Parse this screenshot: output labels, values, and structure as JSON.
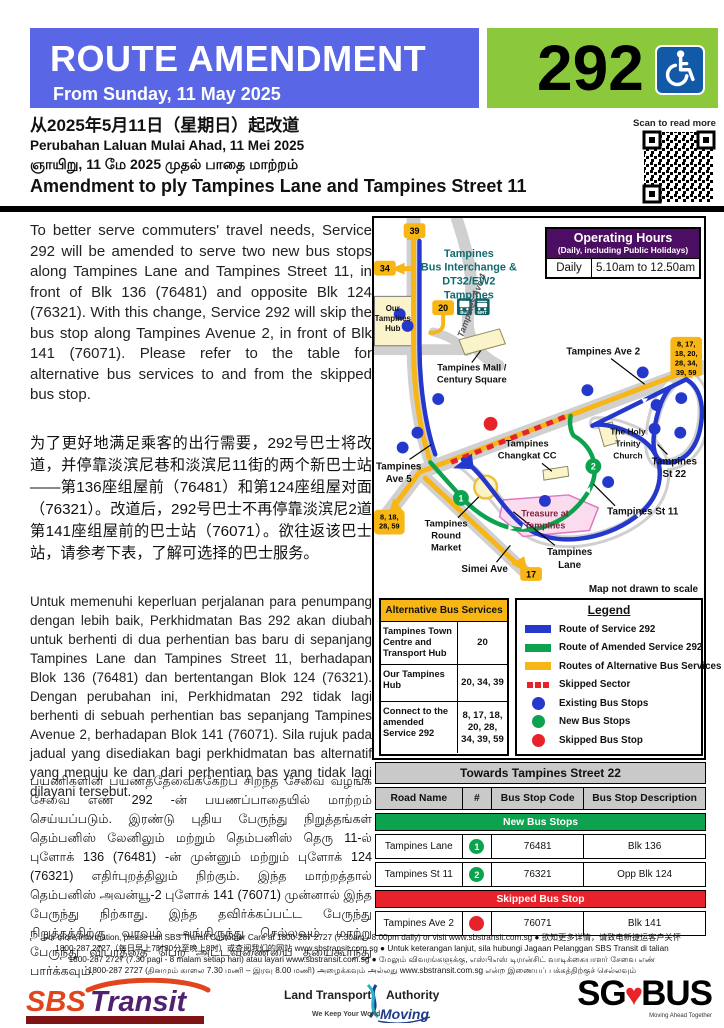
{
  "banner": {
    "title": "ROUTE AMENDMENT",
    "subtitle": "From Sunday, 11 May 2025",
    "service_number": "292",
    "banner_color": "#5967E6",
    "service_box_color": "#8CC83C"
  },
  "qr": {
    "label": "Scan to read more"
  },
  "headings": {
    "zh": "从2025年5月11日（星期日）起改道",
    "ms": "Perubahan Laluan Mulai Ahad, 11 Mei 2025",
    "ta": "ஞாயிறு, 11 மே 2025 முதல் பாதை மாற்றம்",
    "en": "Amendment to ply Tampines Lane and Tampines Street 11"
  },
  "paragraphs": {
    "en": "To better serve commuters' travel needs, Service 292 will be amended to serve two new bus stops along Tampines Lane and Tampines Street 11, in front of Blk 136 (76481) and opposite Blk 124 (76321). With this change, Service 292 will skip the bus stop along Tampines Avenue 2, in front of Blk 141 (76071). Please refer to the table for alternative bus services to and from the skipped bus stop.",
    "zh": "为了更好地满足乘客的出行需要，292号巴士将改道，并停靠淡滨尼巷和淡滨尼11街的两个新巴士站——第136座组屋前（76481）和第124座组屋对面（76321）。改道后，292号巴士不再停靠淡滨尼2道第141座组屋前的巴士站（76071）。欲往返该巴士站，请参考下表，了解可选择的巴士服务。",
    "ms": "Untuk memenuhi keperluan perjalanan para penumpang dengan lebih baik, Perkhidmatan Bas 292 akan diubah untuk berhenti di dua perhentian bas baru di sepanjang Tampines Lane dan Tampines Street 11, berhadapan Blok 136 (76481) dan bertentangan Blok 124 (76321). Dengan perubahan ini, Perkhidmatan 292 tidak lagi berhenti di sebuah perhentian bas sepanjang Tampines Avenue 2, berhadapan Blok 141 (76071). Sila rujuk pada jadual yang disediakan bagi perkhidmatan bas alternatif yang menuju ke dan dari perhentian bas yang tidak lagi dilayani tersebut.",
    "ta": "பயணிகளின் பயணத்தேவைக்கேற்ப சிறந்த சேவை வழங்க சேவை எண் 292 -ன் பயணப்பாதையில் மாற்றம் செய்யப்படும். இரண்டு புதிய பேருந்து நிறுத்தங்கள் தெம்பனிஸ் லேனிலும் மற்றும் தெம்பனிஸ் தெரு 11-ல் புளோக் 136 (76481) -ன் முன்னும் மற்றும் புளோக் 124 (76321) எதிர்புறத்திலும் நிற்கும். இந்த மாற்றத்தால் தெம்பனிஸ் அவன்யூ-2 புளோக் 141 (76071) முன்னால் இந்த பேருந்து நிற்காது. இந்த தவிர்க்கப்பட்ட பேருந்து நிறுத்தத்திற்கு வரவும் அங்கிருந்து செல்லவும் மாற்று பேருந்து விபரத்தை பெற அட்டவணையை தயைகூர்ந்து பார்க்கவும்."
  },
  "operating_hours": {
    "title": "Operating Hours",
    "subtitle": "(Daily, including Public Holidays)",
    "rows": [
      {
        "label": "Daily",
        "value": "5.10am to 12.50am"
      }
    ]
  },
  "map": {
    "note": "Map not drawn to scale",
    "labels": {
      "interchange": [
        "Tampines",
        "Bus Interchange &",
        "DT32/EW2",
        "Tampines"
      ],
      "hub": [
        "Our",
        "Tampines",
        "Hub"
      ],
      "ave4": "Tampines Ave 4",
      "mall": [
        "Tampines Mall /",
        "Century Square"
      ],
      "ave2": "Tampines Ave 2",
      "ave5": [
        "Tampines",
        "Ave 5"
      ],
      "changkat": [
        "Tampines",
        "Changkat CC"
      ],
      "holy_trinity": [
        "The Holy",
        "Trinity",
        "Church"
      ],
      "st22": [
        "Tampines",
        "St 22"
      ],
      "st11": "Tampines St 11",
      "treasure": [
        "Treasure at",
        "Tampines"
      ],
      "round_market": [
        "Tampines",
        "Round",
        "Market"
      ],
      "lane": [
        "Tampines",
        "Lane"
      ],
      "simei": "Simei Ave"
    },
    "badges": {
      "b39": "39",
      "b34": "34",
      "b20": "20",
      "b17": "17",
      "b_left": [
        "8, 18,",
        "28, 59"
      ],
      "b_right": [
        "8, 17,",
        "18, 20,",
        "28, 34,",
        "39, 59"
      ]
    },
    "icons": {
      "bus": "Bus",
      "mrt": "MRT"
    },
    "stop_numbers": {
      "n1": "1",
      "n2": "2"
    },
    "colors": {
      "route_292": "#2438CC",
      "route_amended": "#0CA24E",
      "route_alternative": "#F7B516",
      "skipped": "#E8222A",
      "road": "#D0D0D0"
    }
  },
  "alt_services": {
    "title": "Alternative Bus Services",
    "rows": [
      {
        "destination": "Tampines Town Centre and Transport Hub",
        "services": "20"
      },
      {
        "destination": "Our Tampines Hub",
        "services": "20, 34, 39"
      },
      {
        "destination": "Connect to the amended Service 292",
        "services": "8, 17, 18, 20, 28, 34, 39, 59"
      }
    ]
  },
  "legend": {
    "title": "Legend",
    "items": [
      {
        "swatch": "bar",
        "color": "#2438CC",
        "label": "Route of Service 292"
      },
      {
        "swatch": "bar",
        "color": "#0CA24E",
        "label": "Route of Amended Service 292"
      },
      {
        "swatch": "bar",
        "color": "#F7B516",
        "label": "Routes of Alternative Bus Services"
      },
      {
        "swatch": "dash",
        "color": "#E8222A",
        "label": "Skipped Sector"
      },
      {
        "swatch": "dot",
        "color": "#2438CC",
        "label": "Existing Bus Stops"
      },
      {
        "swatch": "dot",
        "color": "#0CA24E",
        "label": "New Bus Stops"
      },
      {
        "swatch": "dot",
        "color": "#E8222A",
        "label": "Skipped Bus Stop"
      }
    ]
  },
  "stops_table": {
    "title": "Towards Tampines Street 22",
    "headers": [
      "Road Name",
      "#",
      "Bus Stop Code",
      "Bus Stop Description"
    ],
    "sections": [
      {
        "header": "New Bus Stops",
        "color": "#0CA24E",
        "rows": [
          [
            "Tampines Lane",
            "1",
            "76481",
            "Blk 136"
          ],
          [
            "Tampines St 11",
            "2",
            "76321",
            "Opp Blk 124"
          ]
        ]
      },
      {
        "header": "Skipped Bus Stop",
        "color": "#E8222A",
        "rows": [
          [
            "Tampines Ave 2",
            "",
            "76071",
            "Blk 141"
          ]
        ]
      }
    ]
  },
  "footer": {
    "lines": [
      "For more information, please call SBS Transit Customer Care at 1800-287 2727 (7.30am - 8.00pm daily) or visit www.sbstransit.com.sg ● 欲知更多详情，请致电新捷运客户关怀",
      "1800-287 2727（每日早上7时30分至晚上8时）或查阅我们的网站 www.sbstransit.com.sg ● Untuk keterangan lanjut, sila hubungi Jagaan Pelanggan SBS Transit di talian",
      "1800-287 2727 (7.30 pagi - 8 malam setiap hari) atau layari www.sbstransit.com.sg ● மேலும் விவரங்களுக்கு, எஸ்பிஎஸ் டிரான்சிட் வாடிக்கையாளர் சேவை எண்",
      "1800-287 2727 (தினமும் காலை 7.30 மணி – இரவு 8.00 மணி) அழைக்கவும் அல்லது www.sbstransit.com.sg என்ற இணையப் பக்கத்திற்குச் செல்லவும்"
    ]
  },
  "logos": {
    "sbs": {
      "part1": "SBS",
      "part2": "Transit"
    },
    "lta": {
      "line1a": "Land Transport",
      "line1b": "Authority",
      "line2a": "We Keep Your World",
      "line2b": "Moving"
    },
    "sgbus": {
      "sg": "SG",
      "bus": "BUS",
      "tagline": "Moving Ahead Together"
    }
  }
}
